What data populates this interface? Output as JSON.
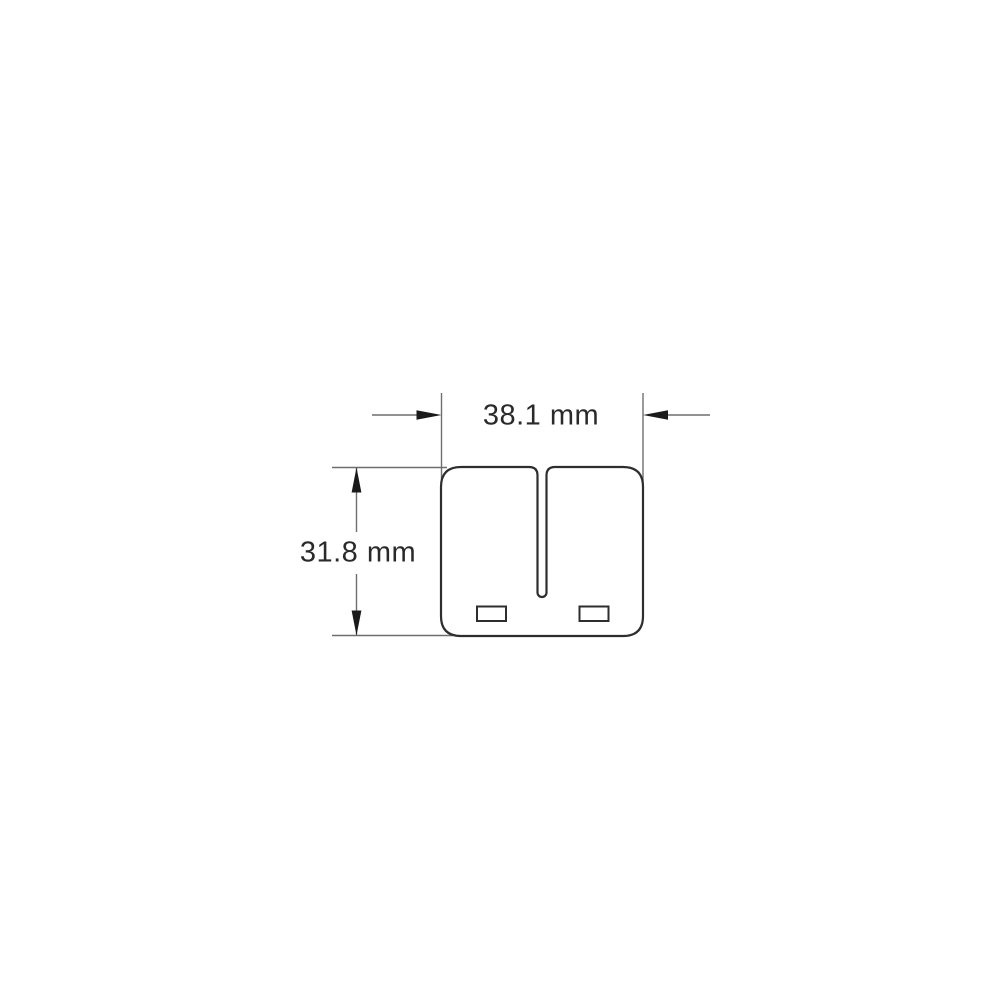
{
  "diagram": {
    "type": "technical-dimension-drawing",
    "width_label": "38.1 mm",
    "height_label": "31.8 mm"
  },
  "colors": {
    "background": "#ffffff",
    "outline": "#2e2e2e",
    "dimension_line": "#6e6e6e",
    "arrow": "#1a1a1a",
    "text": "#2a2a2a"
  }
}
